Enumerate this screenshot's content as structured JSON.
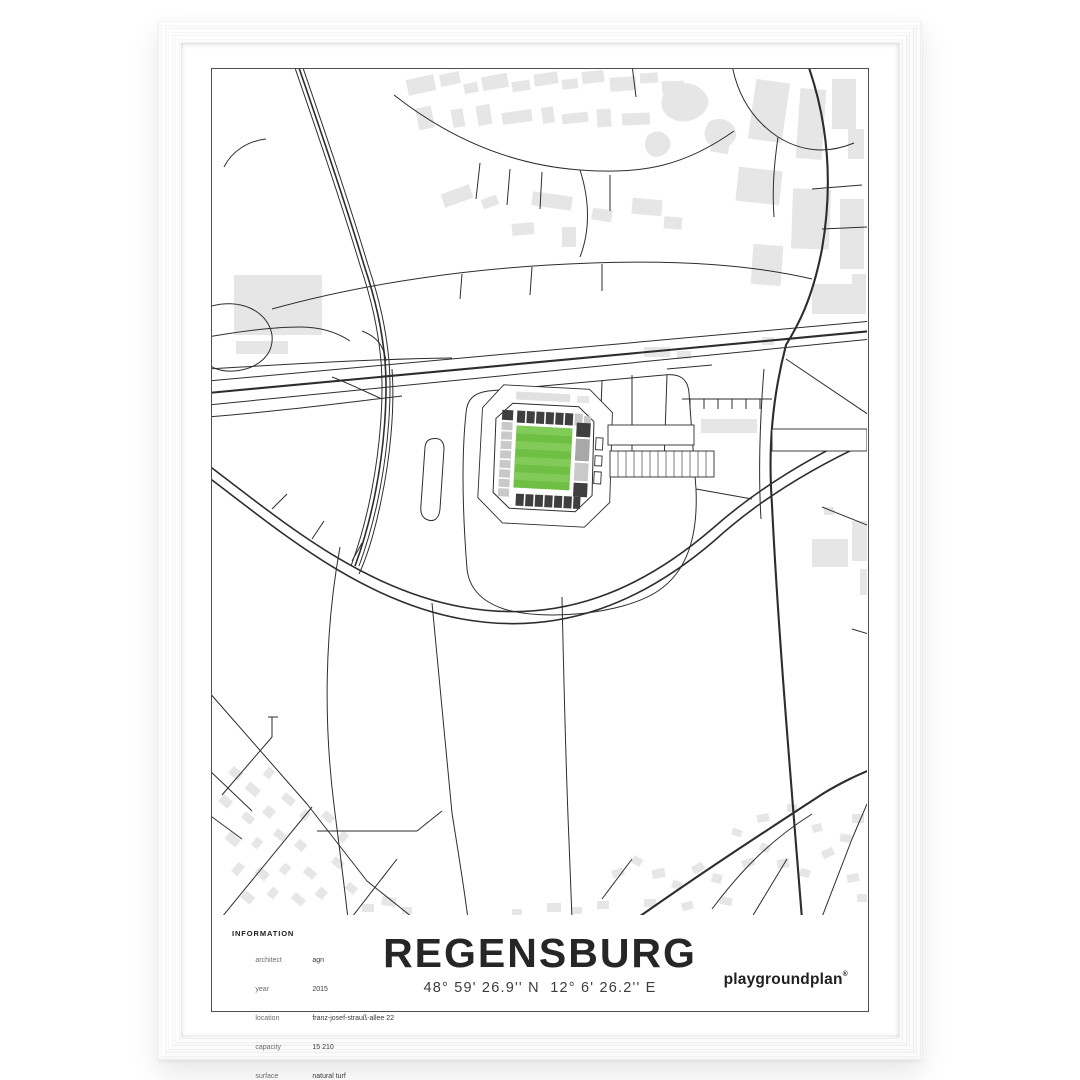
{
  "poster": {
    "title": "REGENSBURG",
    "coordinates": "48° 59' 26.9'' N  12° 6' 26.2'' E",
    "brand": "playgroundplan",
    "brand_mark": "®",
    "info": {
      "heading": "INFORMATION",
      "rows": [
        {
          "label": "architect",
          "value": "agn"
        },
        {
          "label": "year",
          "value": "2015"
        },
        {
          "label": "location",
          "value": "franz-josef-strauß-allee 22"
        },
        {
          "label": "capacity",
          "value": "15 210"
        },
        {
          "label": "surface",
          "value": "natural turf"
        },
        {
          "label": "field size",
          "value": "105 m × 68 m"
        }
      ]
    },
    "colors": {
      "page_bg": "#ffffff",
      "frame_white": "#fbfbfb",
      "mat_white": "#ffffff",
      "border_line": "#4f4f4f",
      "road_dark": "#2d2d2d",
      "building_gray": "#e6e6e6",
      "stand_dark": "#3f3f3f",
      "stand_mid": "#a8a8a8",
      "stand_light": "#c9c9c9",
      "pitch_green": "#6fbf45",
      "pitch_stripe": "#83cb59",
      "text_dark": "#262626",
      "text_gray": "#6b6b6b"
    }
  }
}
